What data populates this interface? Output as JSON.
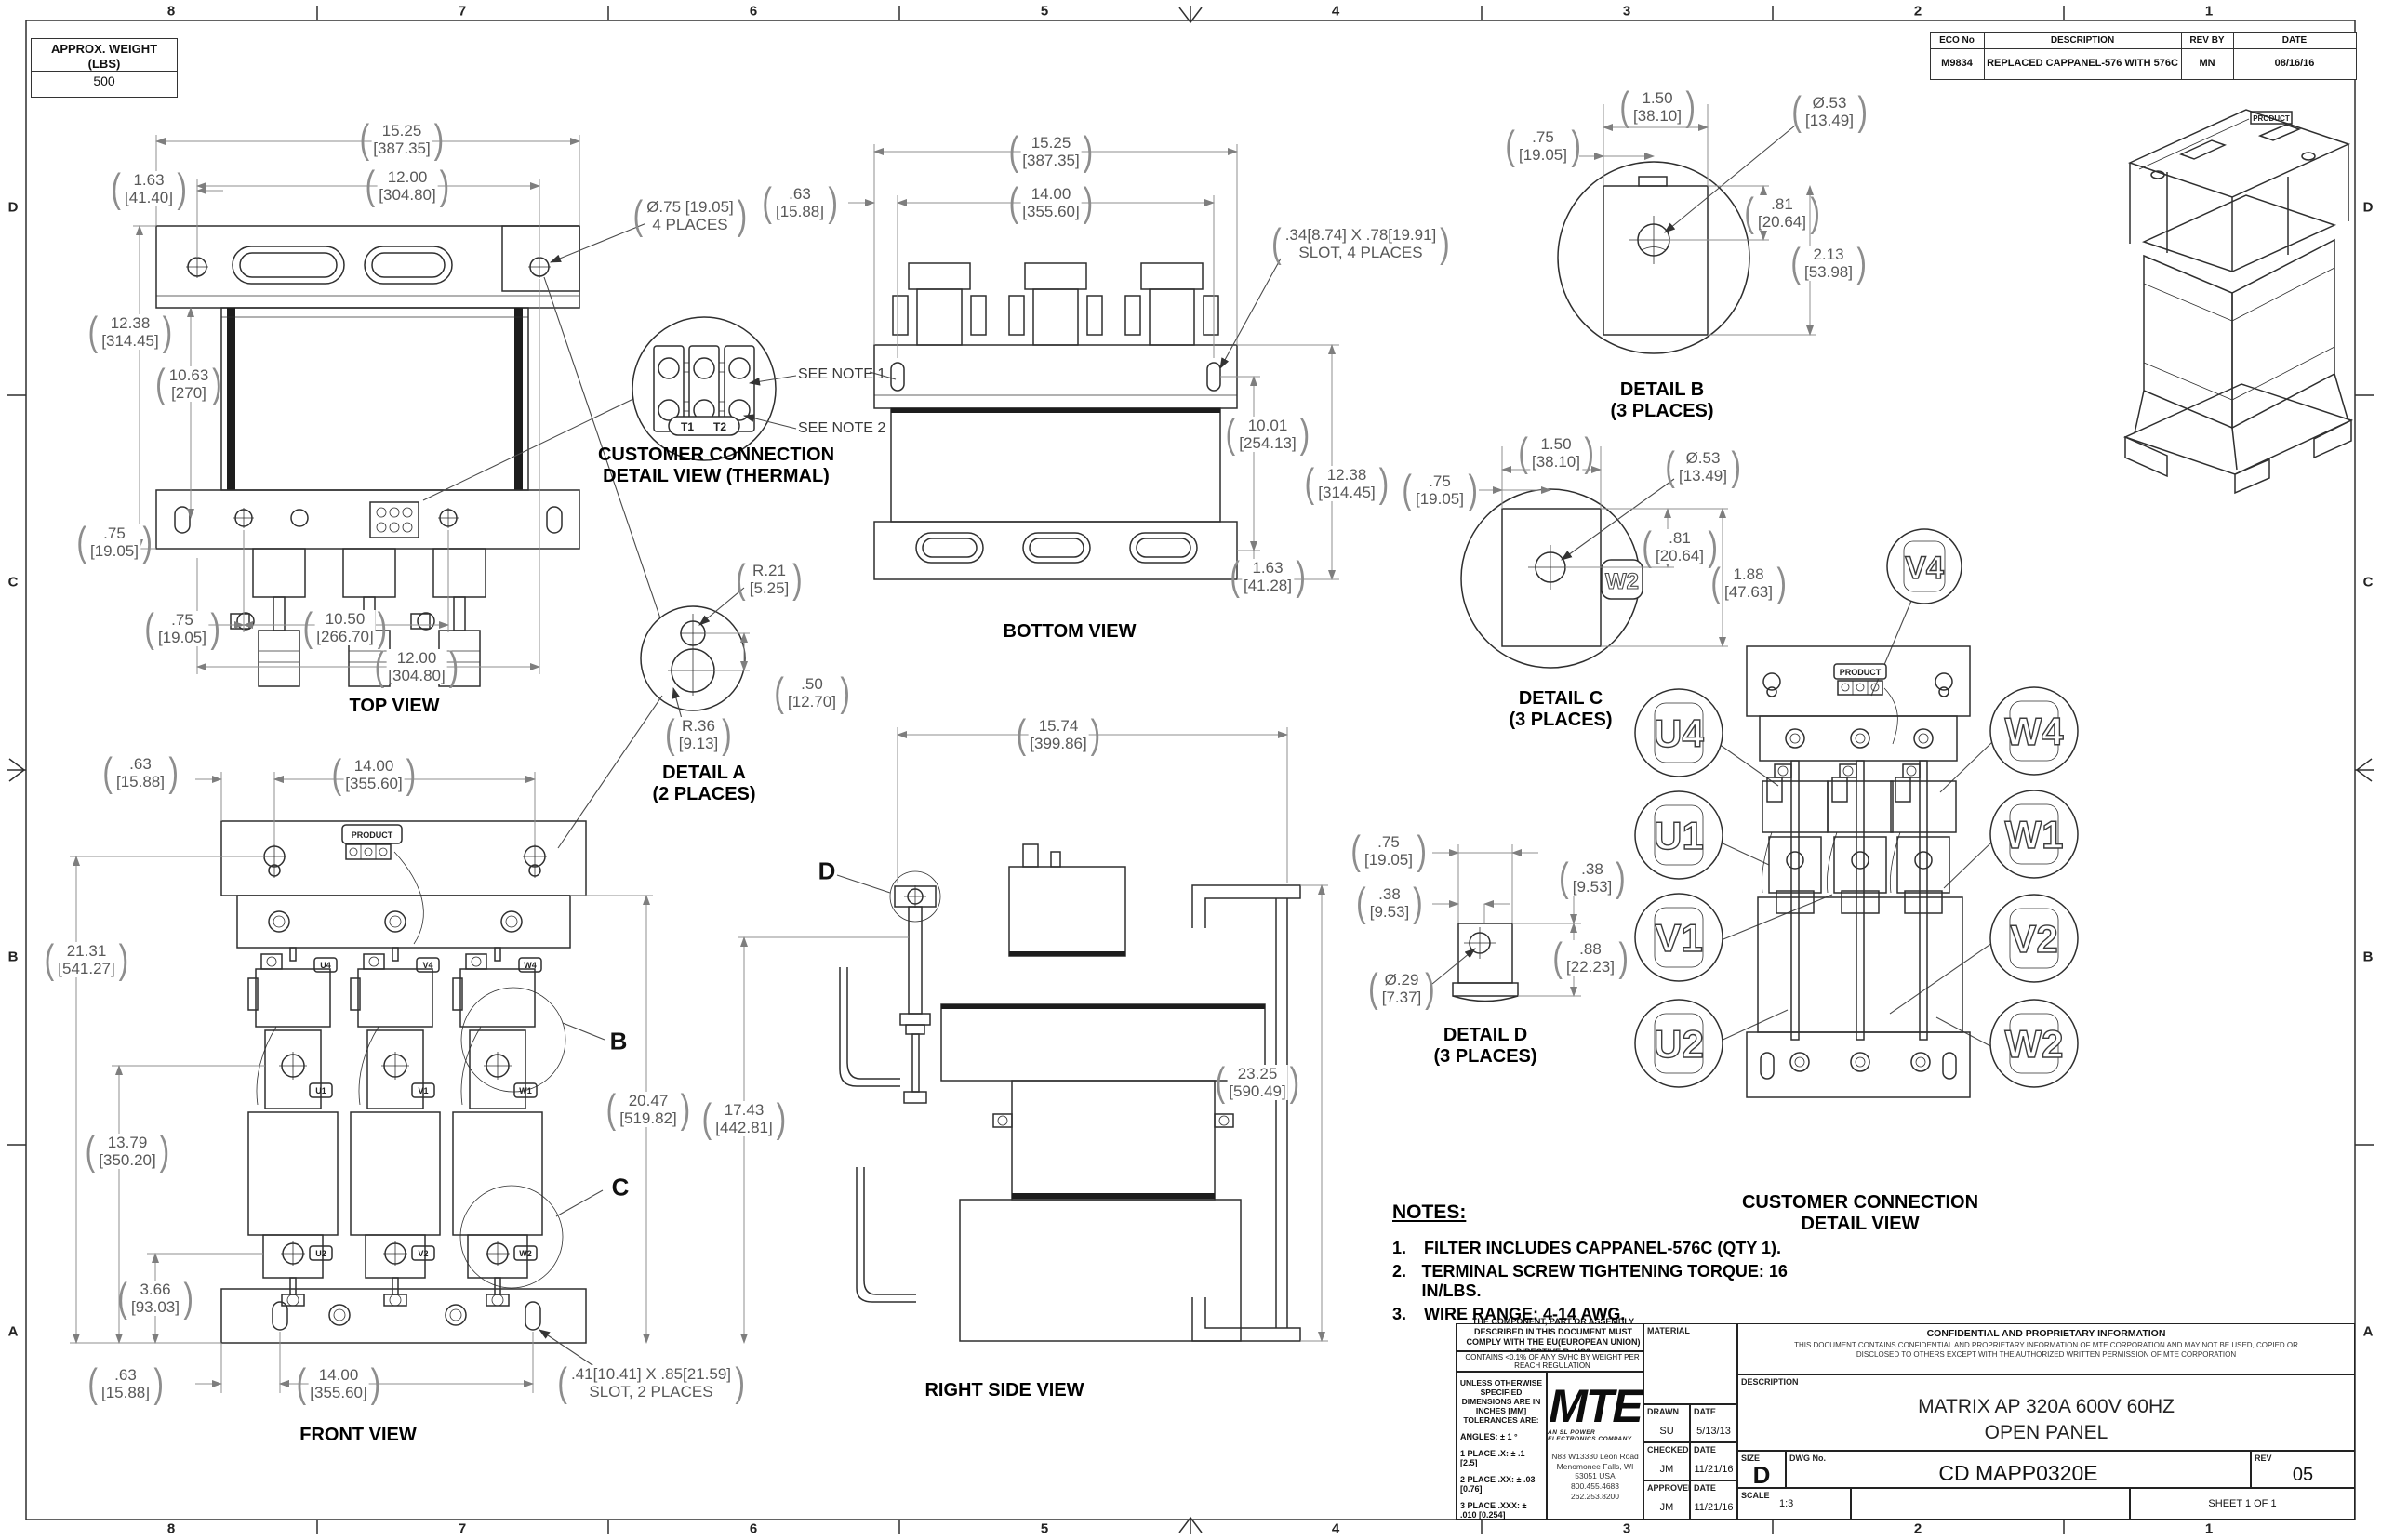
{
  "sheet": {
    "zones_h": [
      "8",
      "7",
      "6",
      "5",
      "4",
      "3",
      "2",
      "1"
    ],
    "zones_v": [
      "D",
      "C",
      "B",
      "A"
    ]
  },
  "weight_box": {
    "title": "APPROX. WEIGHT",
    "unit": "(LBS)",
    "value": "500"
  },
  "eco_table": {
    "headers": [
      "ECO No",
      "DESCRIPTION",
      "REV BY",
      "DATE"
    ],
    "row": [
      "M9834",
      "REPLACED CAPPANEL-576 WITH 576C",
      "MN",
      "08/16/16"
    ]
  },
  "views": {
    "top_view": {
      "label": "TOP VIEW",
      "dims": {
        "width_outer": {
          "a": "15.25",
          "b": "[387.35]"
        },
        "width_inner": {
          "a": "12.00",
          "b": "[304.80]"
        },
        "offset_top": {
          "a": "1.63",
          "b": "[41.40]"
        },
        "holes": {
          "a": "Ø.75 [19.05]",
          "b": "4 PLACES"
        },
        "height_outer": {
          "a": "12.38",
          "b": "[314.45]"
        },
        "height_inner": {
          "a": "10.63",
          "b": "[270]"
        },
        "offset_left": {
          "a": ".75",
          "b": "[19.05]"
        },
        "offset_bottom": {
          "a": ".75",
          "b": "[19.05]"
        },
        "width_bottom_inner": {
          "a": "10.50",
          "b": "[266.70]"
        },
        "width_bottom": {
          "a": "12.00",
          "b": "[304.80]"
        }
      }
    },
    "thermal_detail": {
      "label1": "CUSTOMER CONNECTION",
      "label2": "DETAIL VIEW (THERMAL)",
      "see_note_1": "SEE NOTE 1",
      "see_note_2": "SEE NOTE 2",
      "t1": "T1",
      "t2": "T2"
    },
    "detail_a": {
      "label1": "DETAIL A",
      "label2": "(2 PLACES)",
      "dims": {
        "r_top": {
          "a": "R.21",
          "b": "[5.25]"
        },
        "offset": {
          "a": ".50",
          "b": "[12.70]"
        },
        "r_bottom": {
          "a": "R.36",
          "b": "[9.13]"
        }
      }
    },
    "bottom_view": {
      "label": "BOTTOM VIEW",
      "dims": {
        "width_outer": {
          "a": "15.25",
          "b": "[387.35]"
        },
        "width_inner": {
          "a": "14.00",
          "b": "[355.60]"
        },
        "offset_left": {
          "a": ".63",
          "b": "[15.88]"
        },
        "slot": {
          "a": ".34[8.74] X .78[19.91]",
          "b": "SLOT, 4 PLACES"
        },
        "height_inner": {
          "a": "10.01",
          "b": "[254.13]"
        },
        "height_outer": {
          "a": "12.38",
          "b": "[314.45]"
        },
        "offset_bottom": {
          "a": "1.63",
          "b": "[41.28]"
        }
      }
    },
    "detail_b": {
      "label1": "DETAIL B",
      "label2": "(3 PLACES)",
      "dims": {
        "width": {
          "a": "1.50",
          "b": "[38.10]"
        },
        "offset": {
          "a": ".75",
          "b": "[19.05]"
        },
        "hole": {
          "a": "Ø.53",
          "b": "[13.49]"
        },
        "upper": {
          "a": ".81",
          "b": "[20.64]"
        },
        "height": {
          "a": "2.13",
          "b": "[53.98]"
        }
      }
    },
    "detail_c": {
      "label1": "DETAIL C",
      "label2": "(3 PLACES)",
      "tag": "W2",
      "dims": {
        "width": {
          "a": "1.50",
          "b": "[38.10]"
        },
        "offset": {
          "a": ".75",
          "b": "[19.05]"
        },
        "hole": {
          "a": "Ø.53",
          "b": "[13.49]"
        },
        "upper": {
          "a": ".81",
          "b": "[20.64]"
        },
        "height": {
          "a": "1.88",
          "b": "[47.63]"
        }
      }
    },
    "detail_d": {
      "label1": "DETAIL D",
      "label2": "(3 PLACES)",
      "dims": {
        "width": {
          "a": ".75",
          "b": "[19.05]"
        },
        "offset_left": {
          "a": ".38",
          "b": "[9.53]"
        },
        "offset_right": {
          "a": ".38",
          "b": "[9.53]"
        },
        "height": {
          "a": ".88",
          "b": "[22.23]"
        },
        "hole": {
          "a": "Ø.29",
          "b": "[7.37]"
        }
      }
    },
    "front_view": {
      "label": "FRONT VIEW",
      "product": "PRODUCT",
      "callout_b": "B",
      "callout_c": "C",
      "tags": {
        "top": [
          "U4",
          "V4",
          "W4"
        ],
        "mid": [
          "U1",
          "V1",
          "W1"
        ],
        "bot": [
          "U2",
          "V2",
          "W2"
        ]
      },
      "dims": {
        "offset_top": {
          "a": ".63",
          "b": "[15.88]"
        },
        "width_top": {
          "a": "14.00",
          "b": "[355.60]"
        },
        "height_total": {
          "a": "21.31",
          "b": "[541.27]"
        },
        "height_mid": {
          "a": "13.79",
          "b": "[350.20]"
        },
        "height_low": {
          "a": "3.66",
          "b": "[93.03]"
        },
        "offset_bottom": {
          "a": ".63",
          "b": "[15.88]"
        },
        "width_bottom": {
          "a": "14.00",
          "b": "[355.60]"
        },
        "slot": {
          "a": ".41[10.41] X .85[21.59]",
          "b": "SLOT, 2 PLACES"
        }
      }
    },
    "right_side_view": {
      "label": "RIGHT SIDE VIEW",
      "callout_d": "D",
      "dims": {
        "width": {
          "a": "15.74",
          "b": "[399.86]"
        },
        "height_front": {
          "a": "20.47",
          "b": "[519.82]"
        },
        "height_mid": {
          "a": "17.43",
          "b": "[442.81]"
        },
        "height_total": {
          "a": "23.25",
          "b": "[590.49]"
        }
      }
    },
    "isometric": {
      "product": "PRODUCT"
    },
    "cc_detail": {
      "label1": "CUSTOMER CONNECTION",
      "label2": "DETAIL VIEW",
      "product": "PRODUCT",
      "circles": [
        "U4",
        "U1",
        "V1",
        "U2",
        "W4",
        "W1",
        "V2",
        "W2",
        "V4"
      ]
    }
  },
  "notes": {
    "title": "NOTES:",
    "items": [
      "FILTER INCLUDES CAPPANEL-576C (QTY 1).",
      "TERMINAL SCREW TIGHTENING TORQUE: 16 IN/LBS.",
      "WIRE RANGE: 4-14 AWG."
    ]
  },
  "title_block": {
    "rohs_line": "THE COMPONENT, PART OR ASSEMBLY DESCRIBED IN THIS DOCUMENT MUST COMPLY WITH THE EU(EUROPEAN UNION) DIRECTIVE RoHS2",
    "reach_line": "CONTAINS <0.1% OF ANY SVHC BY WEIGHT PER REACH REGULATION",
    "tol_header": "UNLESS OTHERWISE SPECIFIED DIMENSIONS ARE IN INCHES [MM] TOLERANCES ARE:",
    "tol_angles": "ANGLES: ± 1 °",
    "tol_1": "1 PLACE .X: ± .1 [2.5]",
    "tol_2": "2 PLACE .XX: ± .03 [0.76]",
    "tol_3": "3 PLACE .XXX: ± .010 [0.254]",
    "logo_text": "MTE",
    "logo_tagline": "AN SL POWER ELECTRONICS COMPANY",
    "address": [
      "N83 W13330 Leon Road",
      "Menomonee Falls, WI 53051 USA",
      "800.455.4683",
      "262.253.8200"
    ],
    "material_label": "MATERIAL",
    "drawn_label": "DRAWN",
    "drawn_by": "SU",
    "drawn_date": "5/13/13",
    "checked_label": "CHECKED",
    "checked_by": "JM",
    "checked_date": "11/21/16",
    "approved_label": "APPROVED",
    "approved_by": "JM",
    "approved_date": "11/21/16",
    "date_label": "DATE",
    "conf_title": "CONFIDENTIAL AND PROPRIETARY INFORMATION",
    "conf_body": "THIS DOCUMENT CONTAINS CONFIDENTIAL AND PROPRIETARY INFORMATION OF MTE CORPORATION AND MAY NOT BE USED, COPIED OR DISCLOSED TO OTHERS EXCEPT WITH THE AUTHORIZED WRITTEN PERMISSION OF MTE CORPORATION",
    "description_label": "DESCRIPTION",
    "description_line1": "MATRIX AP 320A 600V 60HZ",
    "description_line2": "OPEN PANEL",
    "size_label": "SIZE",
    "size_value": "D",
    "dwg_label": "DWG No.",
    "dwg_value": "CD MAPP0320E",
    "rev_label": "REV",
    "rev_value": "05",
    "scale_label": "SCALE",
    "scale_value": "1:3",
    "sheet_value": "SHEET 1  OF 1"
  }
}
